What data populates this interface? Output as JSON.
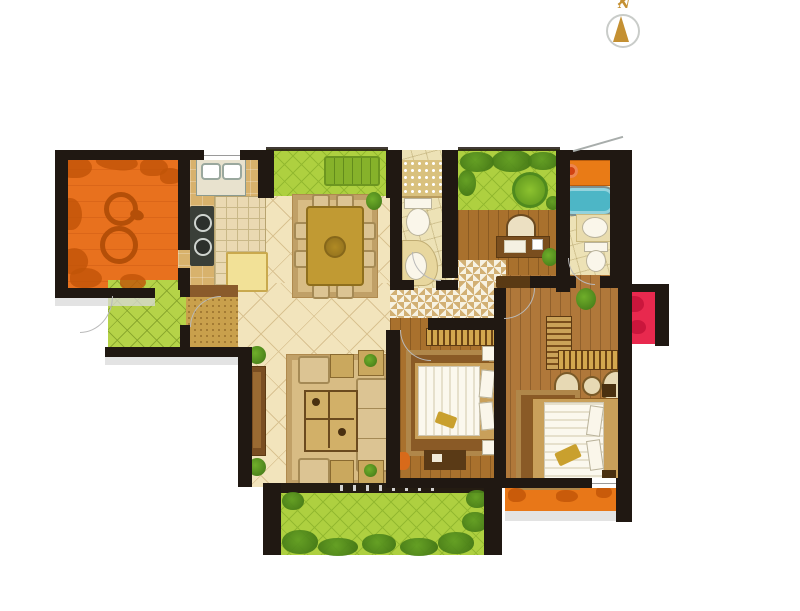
{
  "compass": {
    "label": "N"
  },
  "colors": {
    "wall": "#201812",
    "terrace": "#e8711e",
    "terrace_leaf": "#c05408",
    "kitchen_floor": "#d8b26c",
    "kitchen_tile": "#ead9b2",
    "tile_floor": "#f2e4bc",
    "tile_line": "#d9c291",
    "green": "#aed040",
    "green_line": "#93b92f",
    "porch_green": "#b5d348",
    "wood": "#a9712d",
    "wood_master": "#b0783a",
    "bath_floor": "#ede2b6",
    "tub": "#4db6c6",
    "orange_cabinet": "#e97b16",
    "red_block": "#e8294e",
    "hall_tan": "#d2b074",
    "gold": "#c19a33",
    "rug": "#d8bc84",
    "rug_dark": "#8a5a26",
    "mat": "#c9a04c",
    "mat_dark": "#8a5b2b",
    "fridge": "#f2e197",
    "stove": "#3a3f38",
    "sofa": "#dcc493",
    "shadow": "#d9d9d9",
    "sill": "#241c12",
    "balcony_orange": "#e87718",
    "compass_gold": "#c49032",
    "compass_ring": "#c9ccc9"
  },
  "rooms": [
    {
      "name": "terrace-northwest"
    },
    {
      "name": "kitchen"
    },
    {
      "name": "dining-room"
    },
    {
      "name": "planter-bay-north"
    },
    {
      "name": "bathroom-1"
    },
    {
      "name": "garden-northeast"
    },
    {
      "name": "study"
    },
    {
      "name": "bathroom-2-master"
    },
    {
      "name": "entry-porch"
    },
    {
      "name": "foyer"
    },
    {
      "name": "living-room"
    },
    {
      "name": "bedroom-2"
    },
    {
      "name": "master-bedroom"
    },
    {
      "name": "garden-south"
    },
    {
      "name": "balcony-south"
    },
    {
      "name": "flower-bed-east"
    }
  ]
}
